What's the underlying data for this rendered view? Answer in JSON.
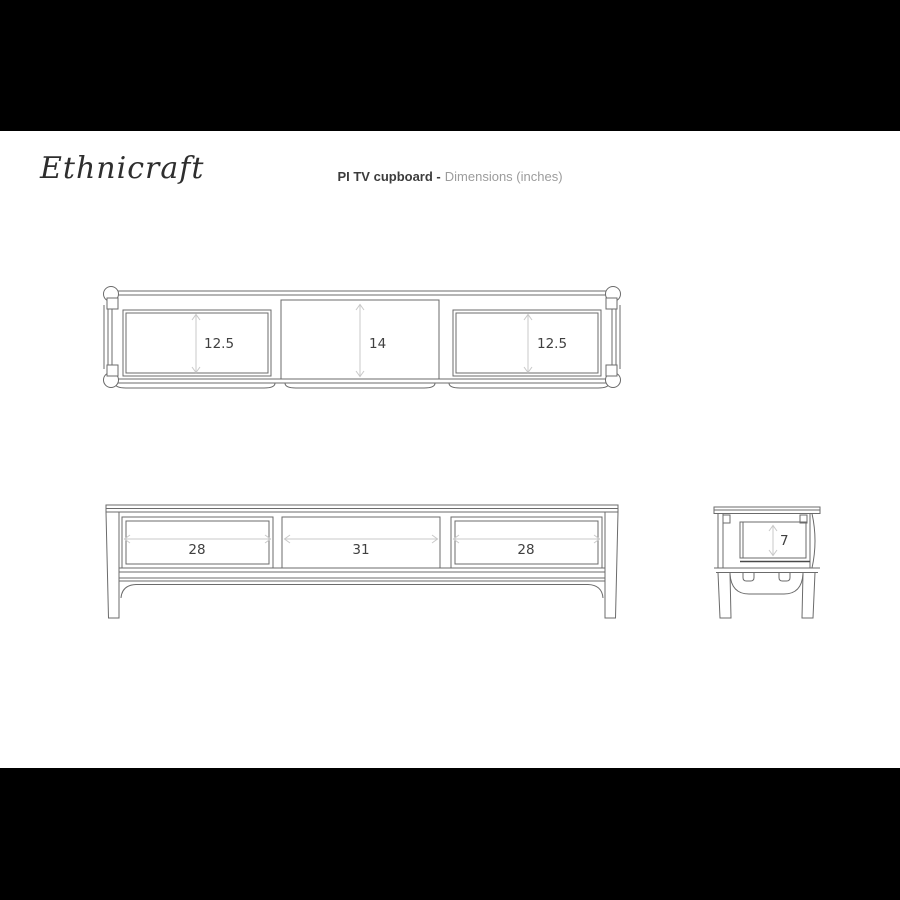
{
  "header": {
    "logo": "Ethnicraft",
    "title_product": "PI TV cupboard -",
    "title_detail": "Dimensions (inches)"
  },
  "views": {
    "top_view": {
      "dims": {
        "left": "12.5",
        "middle": "14",
        "right": "12.5"
      }
    },
    "front_view": {
      "dims": {
        "left": "28",
        "middle": "31",
        "right": "28"
      }
    },
    "side_view": {
      "dims": {
        "depth": "7"
      }
    }
  },
  "colors": {
    "letterbox": "#000000",
    "sheet": "#ffffff",
    "line": "#6b6b6b",
    "dimension_arrow": "#c9c9c9",
    "dimension_text": "#404040",
    "title_text": "#3c3c3c",
    "title_muted": "#9c9c9c",
    "logo_text": "#2e2e2e"
  }
}
